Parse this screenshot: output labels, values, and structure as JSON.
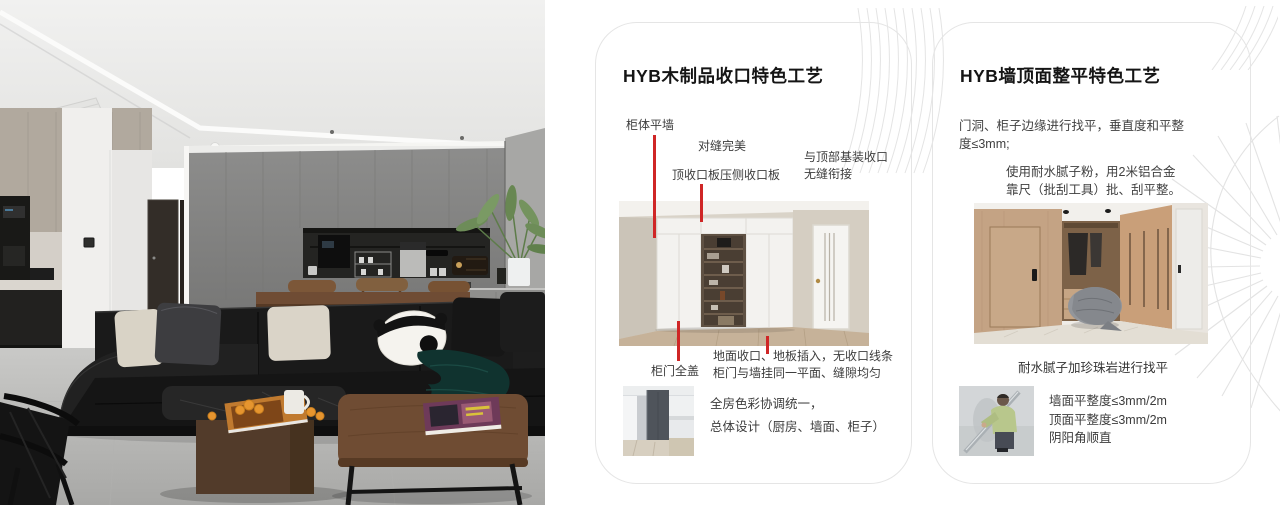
{
  "page": {
    "background": "#ffffff"
  },
  "colors": {
    "annotation_red": "#cf2626",
    "card_border": "#e5e5e5",
    "title": "#151515"
  },
  "left_photo": {
    "description": "modern-living-room-photo"
  },
  "card1": {
    "title": "HYB木制品收口特色工艺",
    "ann_cabinet_flush": "柜体平墙",
    "ann_seam_perfect": "对缝完美",
    "ann_top_board": "顶收口板压侧收口板",
    "ann_ceiling_join_1": "与顶部基装收口",
    "ann_ceiling_join_2": "无缝衔接",
    "ann_door_full_cover": "柜门全盖",
    "ann_floor_join_1": "地面收口、地板插入，无收口线条",
    "ann_floor_join_2": "柜门与墙挂同一平面、缝隙均匀",
    "note_1": "全房色彩协调统一，",
    "note_2": "总体设计（厨房、墙面、柜子）"
  },
  "card2": {
    "title": "HYB墙顶面整平特色工艺",
    "para1_1": "门洞、柜子边缘进行找平，垂直度和平整",
    "para1_2": "度≤3mm;",
    "para2_1": "使用耐水腻子粉，用2米铝合金",
    "para2_2": "靠尺（批刮工具）批、刮平整。",
    "caption": "耐水腻子加珍珠岩进行找平",
    "spec_1": "墙面平整度≤3mm/2m",
    "spec_2": "顶面平整度≤3mm/2m",
    "spec_3": "阴阳角顺直"
  }
}
